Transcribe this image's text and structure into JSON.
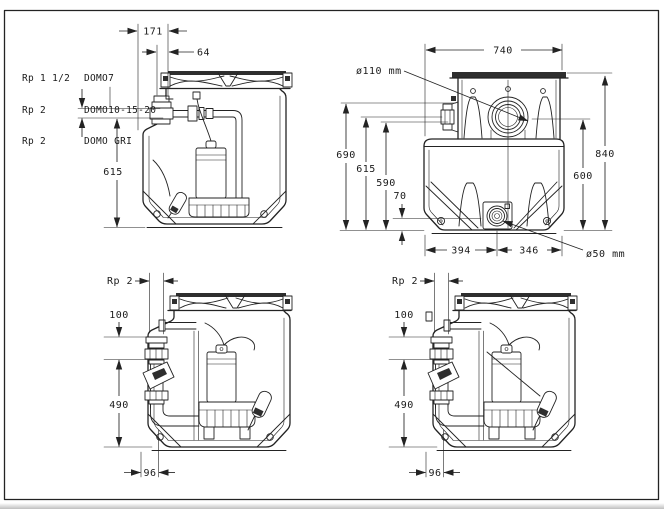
{
  "page": {
    "background": "#ffffff",
    "ink": "#232323",
    "border_color": "#1a1a1a"
  },
  "views": {
    "top_left": {
      "port_labels": [
        {
          "thread": "Rp 1 1/2",
          "model": "DOMO7"
        },
        {
          "thread": "Rp 2",
          "model": "DOMO10-15-20"
        },
        {
          "thread": "Rp 2",
          "model": "DOMO GRI"
        }
      ],
      "dims": {
        "d171": "171",
        "d64": "64",
        "d615": "615"
      }
    },
    "top_right": {
      "dims": {
        "d740": "740",
        "inlet_dia": "ø110 mm",
        "d690": "690",
        "d615": "615",
        "d590": "590",
        "d70": "70",
        "d840": "840",
        "d600": "600",
        "d394": "394",
        "d346": "346",
        "drain_dia": "ø50 mm"
      }
    },
    "bottom_left": {
      "dims": {
        "thread": "Rp 2",
        "d100": "100",
        "d490": "490",
        "d96": "96"
      }
    },
    "bottom_right": {
      "dims": {
        "thread": "Rp 2",
        "d100": "100",
        "d490": "490",
        "d96": "96"
      }
    }
  }
}
